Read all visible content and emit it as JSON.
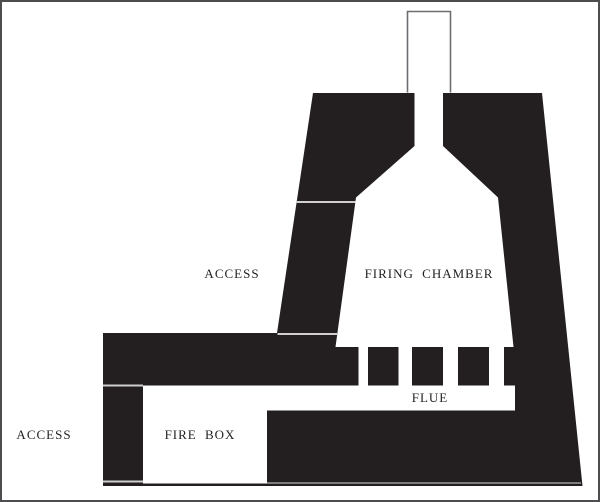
{
  "diagram": {
    "type": "kiln-cross-section",
    "labels": {
      "access_upper": "ACCESS",
      "firing_chamber": "FIRING CHAMBER",
      "flue": "FLUE",
      "access_lower": "ACCESS",
      "fire_box": "FIRE BOX"
    },
    "colors": {
      "ink": "#231f20",
      "background": "#ffffff",
      "chimney_outline": "#6d6e71",
      "seam": "#cfcfcf",
      "seam_faint": "#b3b3b3",
      "frame_border": "#4d4d4f",
      "text": "#231f20"
    }
  }
}
